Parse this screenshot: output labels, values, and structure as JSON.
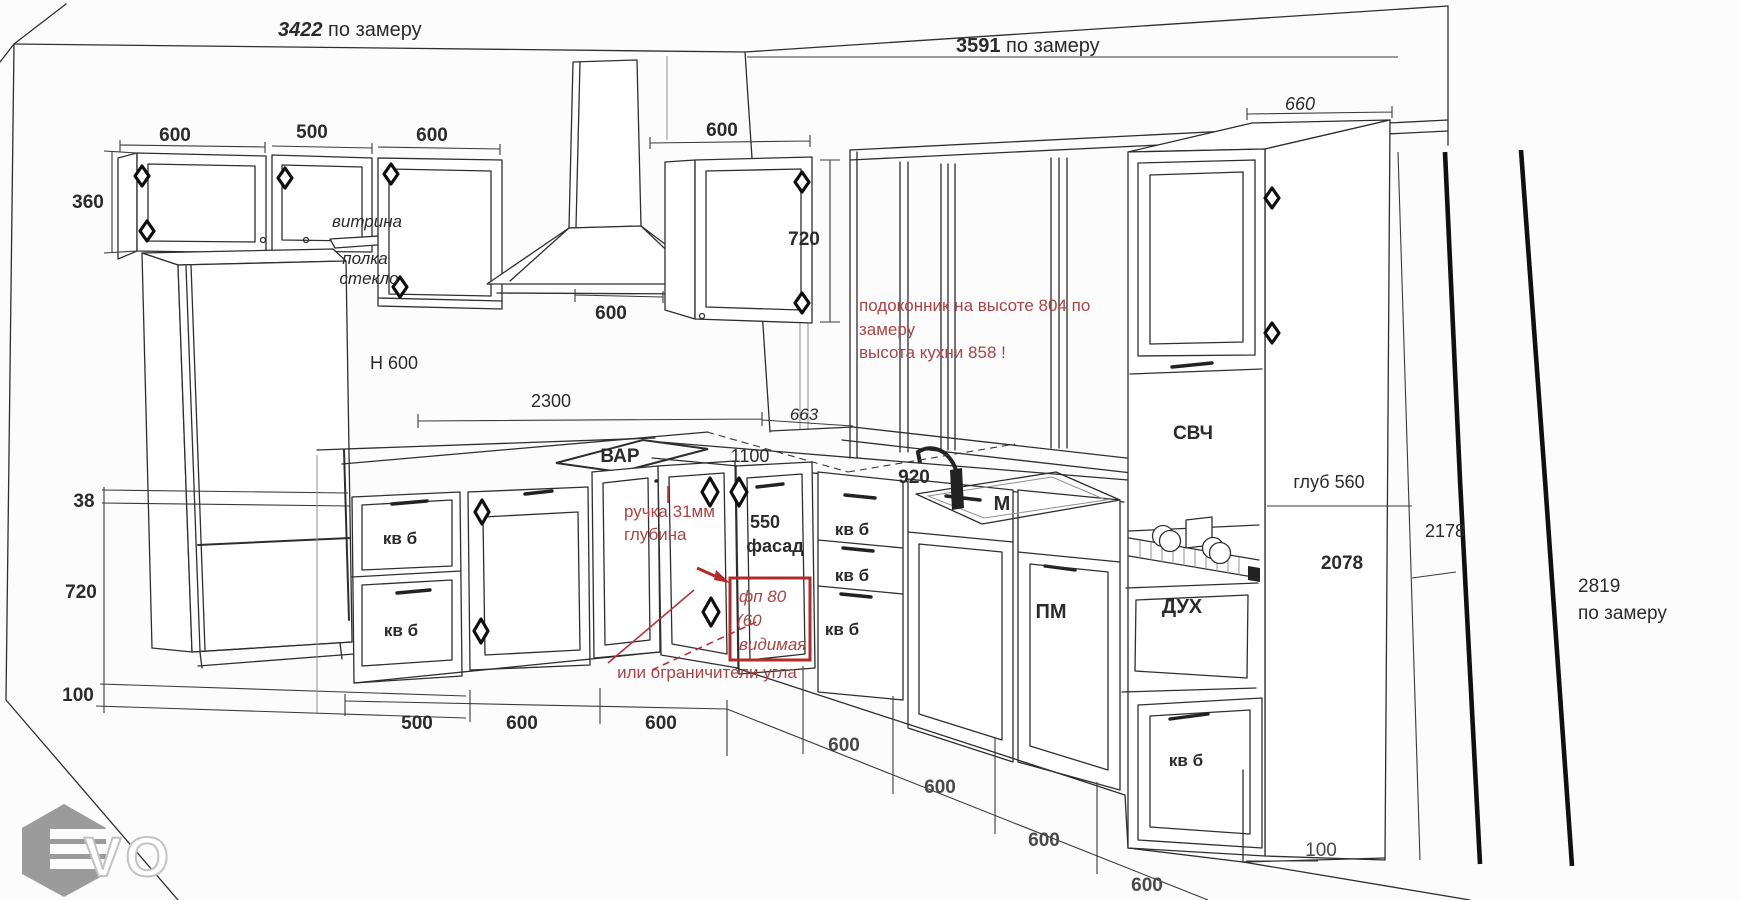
{
  "colors": {
    "ink": "#2e2e2e",
    "red_note": "#a84444",
    "red_box": "#b22b2b",
    "thick_line": "#141414",
    "logo_gray": "#9b9b9b"
  },
  "dims": {
    "wall_left_num": "3422",
    "wall_left_sfx": " по замеру",
    "wall_right_num": "3591",
    "wall_right_sfx": " по замеру",
    "h2819_num": "2819",
    "h2819_sfx": "по замеру",
    "d660": "660",
    "cab1": "600",
    "cab2": "500",
    "cab3": "600",
    "corner_wall": "600",
    "hood": "600",
    "d360": "360",
    "wall720": "720",
    "d2300": "2300",
    "d663": "663",
    "d1100": "1100",
    "d920": "920",
    "d550": "550",
    "glub560": "глуб 560",
    "d2078": "2078",
    "d2178": "2178",
    "d38": "38",
    "left720": "720",
    "left100": "100",
    "b500": "500",
    "b600a": "600",
    "b600b": "600",
    "g600a": "600",
    "g600b": "600",
    "g600c": "600",
    "g600d": "600",
    "right100": "100"
  },
  "labels": {
    "vitrina": "витрина",
    "polka": "полка",
    "steklo": "стекло",
    "h600": "Н 600",
    "var": "ВАР",
    "sink_m": "М",
    "svch": "СВЧ",
    "dukh": "ДУХ",
    "pm": "ПМ",
    "fasad": "фасад",
    "kvb": "кв б",
    "logo": "VO"
  },
  "notes": {
    "sill1": "подоконник на высоте 804 по",
    "sill2": "замеру",
    "sill3": "высота кухни 858 !",
    "handle1": "ручка 31мм",
    "handle2": "глубина",
    "fp1": "фп 80",
    "fp2": "(60",
    "fp3": "видимая",
    "corner": "или ограничители угла"
  }
}
